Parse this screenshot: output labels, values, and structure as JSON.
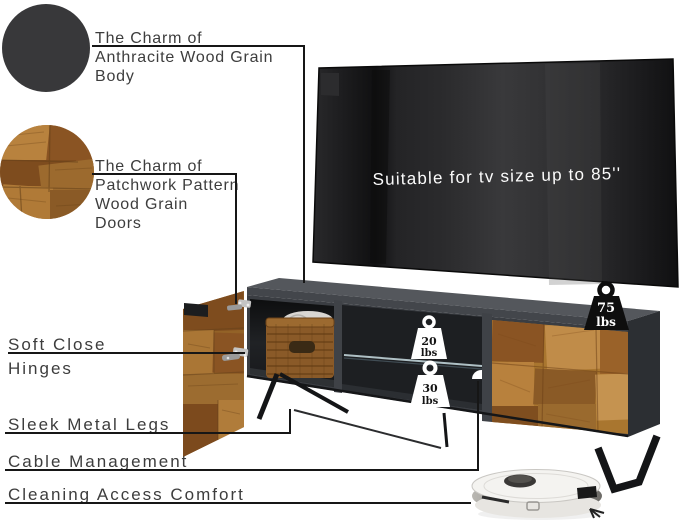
{
  "product": {
    "swatches": {
      "anthracite": {
        "label_lines": [
          "The Charm of",
          "Anthracite Wood Grain",
          "Body"
        ],
        "color": "#38383a"
      },
      "patchwork": {
        "label_lines": [
          "The Charm of",
          "Patchwork Pattern",
          "Wood Grain",
          "Doors"
        ],
        "wood_color": "#a5702f"
      }
    },
    "tv": {
      "caption": "Suitable for tv size up to 85''"
    },
    "weights": {
      "top": {
        "value": "75",
        "unit": "lbs"
      },
      "glass_shelf": {
        "value": "20",
        "unit": "lbs"
      },
      "bottom_shelf": {
        "value": "30",
        "unit": "lbs"
      }
    },
    "features": {
      "soft_close": {
        "lines": [
          "Soft Close",
          "Hinges"
        ]
      },
      "legs": {
        "label": "Sleek Metal Legs"
      },
      "cable": {
        "label": "Cable Management"
      },
      "cleaning": {
        "label": "Cleaning Access Comfort"
      }
    }
  }
}
